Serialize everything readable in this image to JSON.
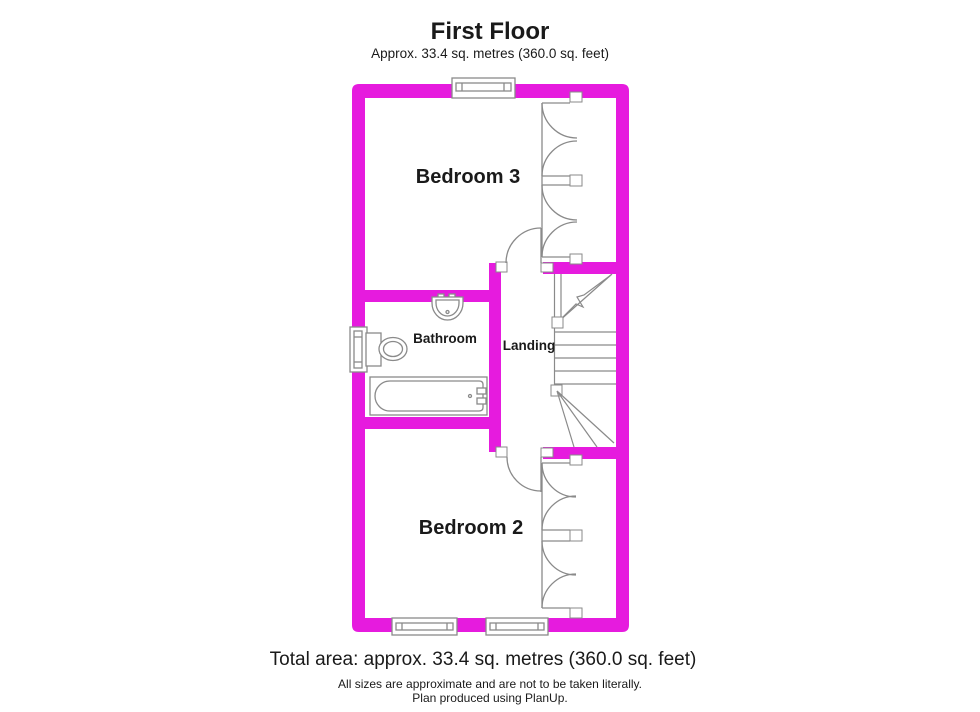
{
  "header": {
    "title": "First Floor",
    "subtitle": "Approx. 33.4 sq. metres (360.0 sq. feet)"
  },
  "rooms": {
    "bedroom3": {
      "label": "Bedroom 3"
    },
    "bathroom": {
      "label": "Bathroom"
    },
    "landing": {
      "label": "Landing"
    },
    "bedroom2": {
      "label": "Bedroom 2"
    }
  },
  "footer": {
    "total_area": "Total area: approx. 33.4 sq. metres (360.0 sq. feet)",
    "disclaimer": "All sizes are approximate and are not to be taken literally.",
    "credit": "Plan produced using PlanUp."
  },
  "colors": {
    "wall": "#E61BDE",
    "line": "#8a8a8a",
    "text": "#1a1a1a",
    "background": "#ffffff"
  }
}
